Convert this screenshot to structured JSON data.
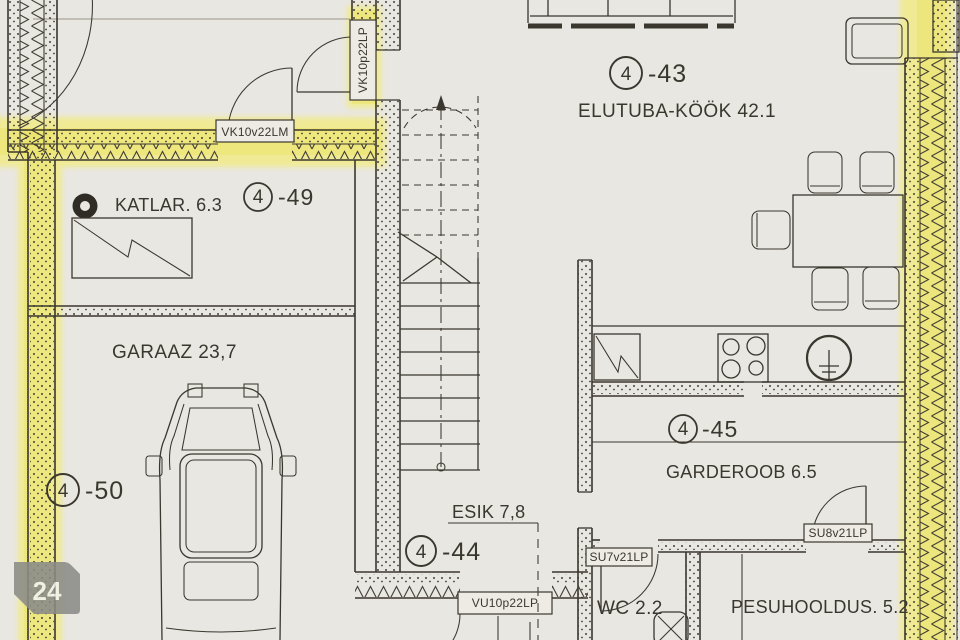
{
  "palette": {
    "paper": "#e9e7e1",
    "ink": "#3a372f",
    "highlight_yellow": "#efe98a",
    "highlight_core": "#e9e259",
    "badge_gray": "#8b8b88",
    "badge_text": "#f3f2ee"
  },
  "unit": {
    "circle": "4"
  },
  "rooms": {
    "elutuba": {
      "suffix": "-43",
      "label": "ELUTUBA-KÖÖK 42.1"
    },
    "katlar": {
      "suffix": "-49",
      "label": "KATLAR. 6.3"
    },
    "garaaz": {
      "suffix": "-50",
      "label": "GARAAZ 23,7"
    },
    "garderoob": {
      "suffix": "-45",
      "label": "GARDEROOB 6.5"
    },
    "esik": {
      "suffix": "-44",
      "label": "ESIK 7,8"
    },
    "wc": {
      "label": "WC 2.2"
    },
    "pesuhooldus": {
      "label": "PESUHOOLDUS. 5.2"
    }
  },
  "openings": {
    "vk10v22lm": "VK10v22LM",
    "vk10p22lp": "VK10p22LP",
    "su7v21lp": "SU7v21LP",
    "su8v21lp": "SU8v21LP",
    "vu10p22lp": "VU10p22LP"
  },
  "badge": {
    "label": "24"
  }
}
